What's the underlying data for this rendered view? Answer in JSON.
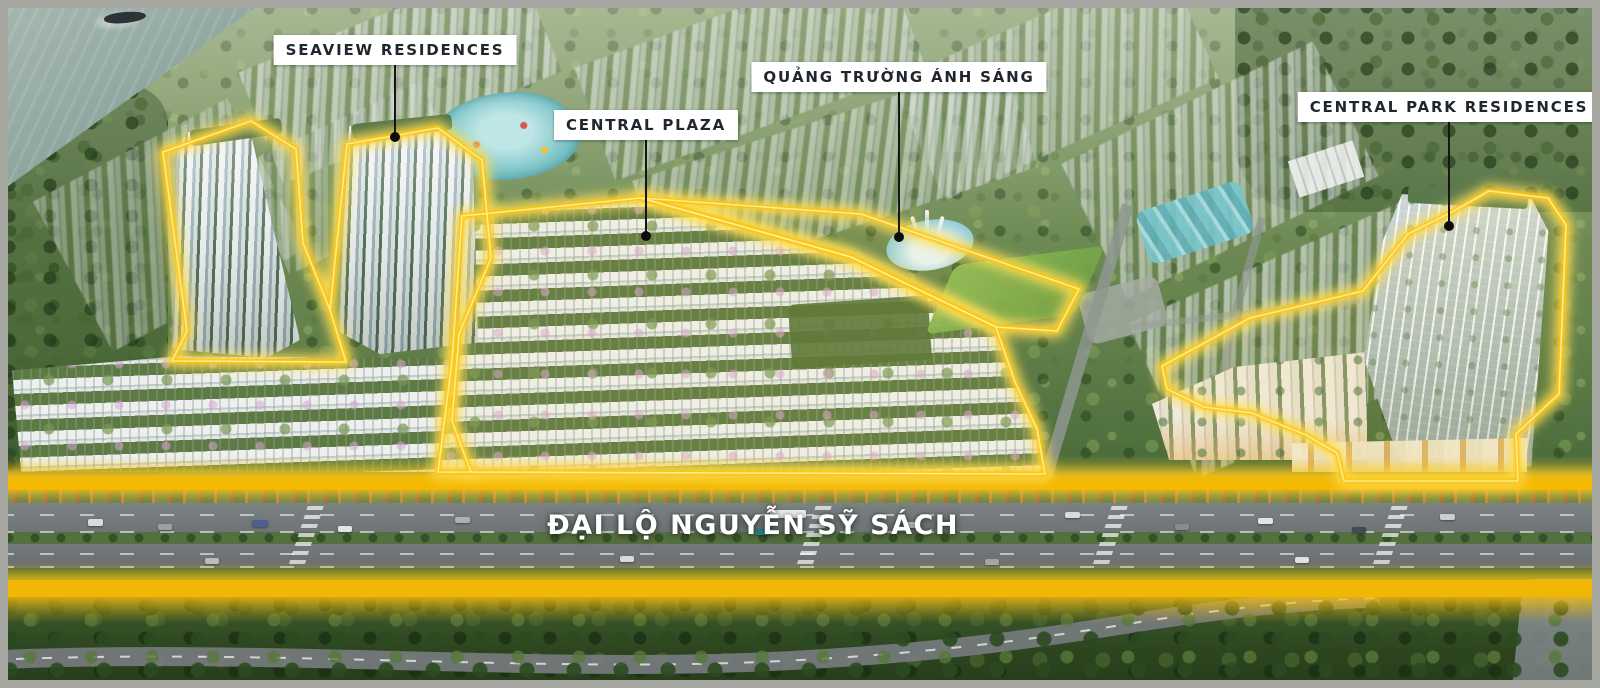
{
  "callouts": [
    {
      "id": "seaview-residences",
      "text": "SEAVIEW RESIDENCES"
    },
    {
      "id": "central-plaza",
      "text": "CENTRAL PLAZA"
    },
    {
      "id": "quang-truong-anh-sang",
      "text": "QUẢNG TRƯỜNG ÁNH SÁNG"
    },
    {
      "id": "central-park-residences",
      "text": "CENTRAL PARK RESIDENCES"
    }
  ],
  "road": {
    "name": "ĐẠI LỘ NGUYỄN SỸ SÁCH"
  },
  "colors": {
    "highlight_band": "#F4B803",
    "outline_glow": "#FFDE55",
    "callout_bg": "#FFFFFF",
    "callout_text": "#20262E",
    "road_text": "#FFFFFF",
    "frame_border": "#A6A6A1",
    "river": "#8DA69F",
    "canopy_green": "#527240"
  }
}
